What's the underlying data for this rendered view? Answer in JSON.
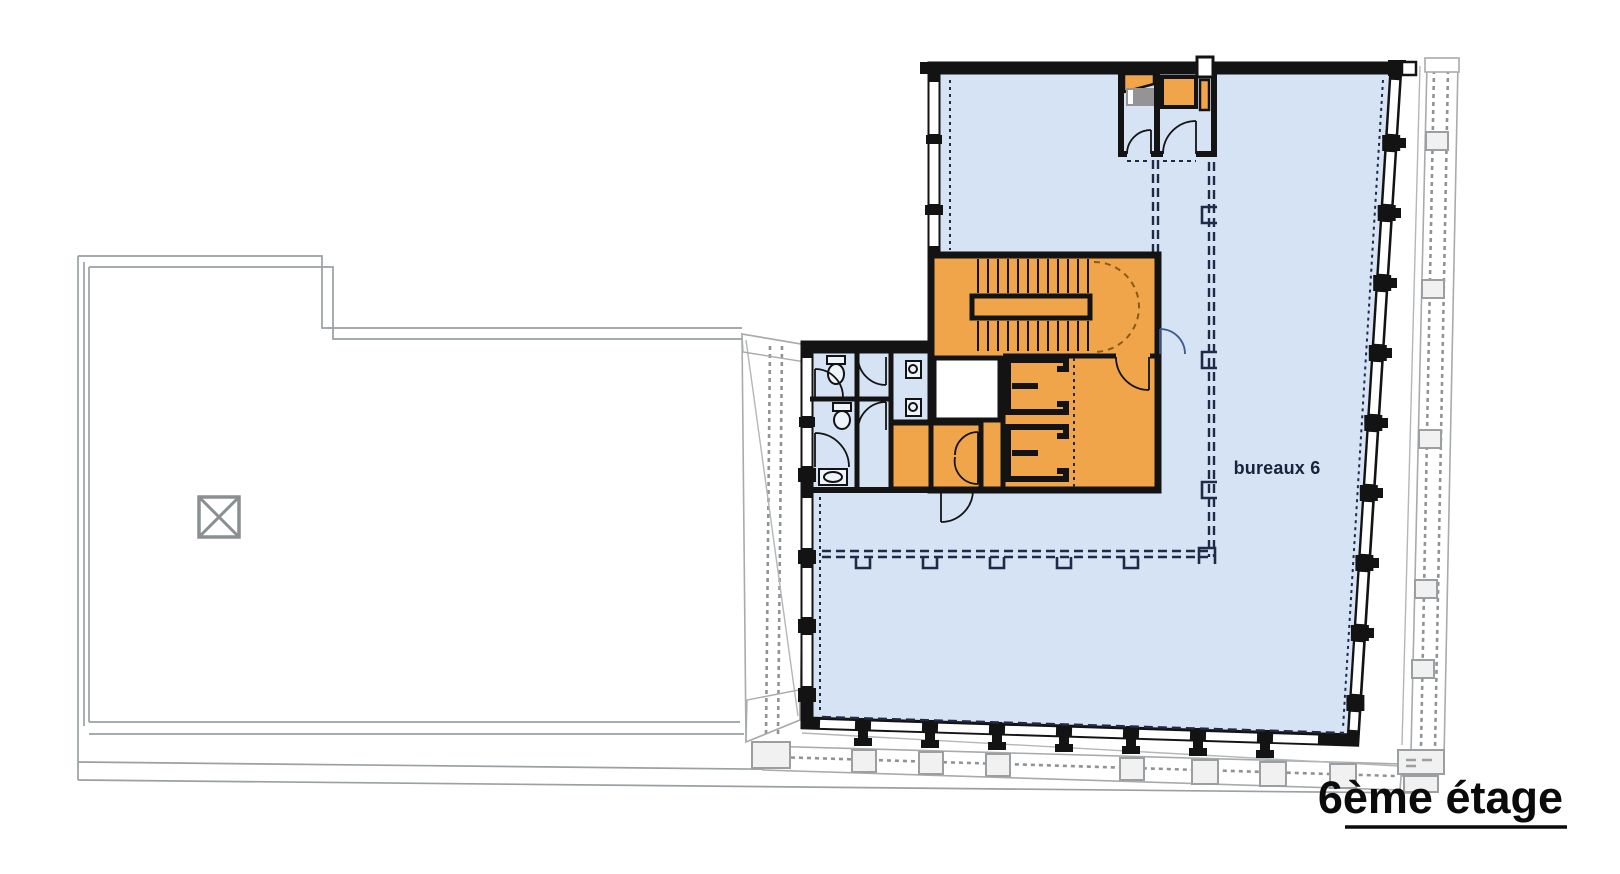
{
  "plan": {
    "floor_title": "6ème étage",
    "rooms": [
      {
        "id": "bureaux-6",
        "label": "bureaux 6",
        "fill_color": "#d5e3f5"
      }
    ],
    "legend_colors": {
      "office_area_blue": "#d5e3f5",
      "core_service_orange": "#f1a54a",
      "walls_black": "#131313",
      "exterior_outline_gray": "#9aa0a3",
      "grid_dashed_navy": "#1e2a46",
      "background": "#ffffff"
    }
  }
}
